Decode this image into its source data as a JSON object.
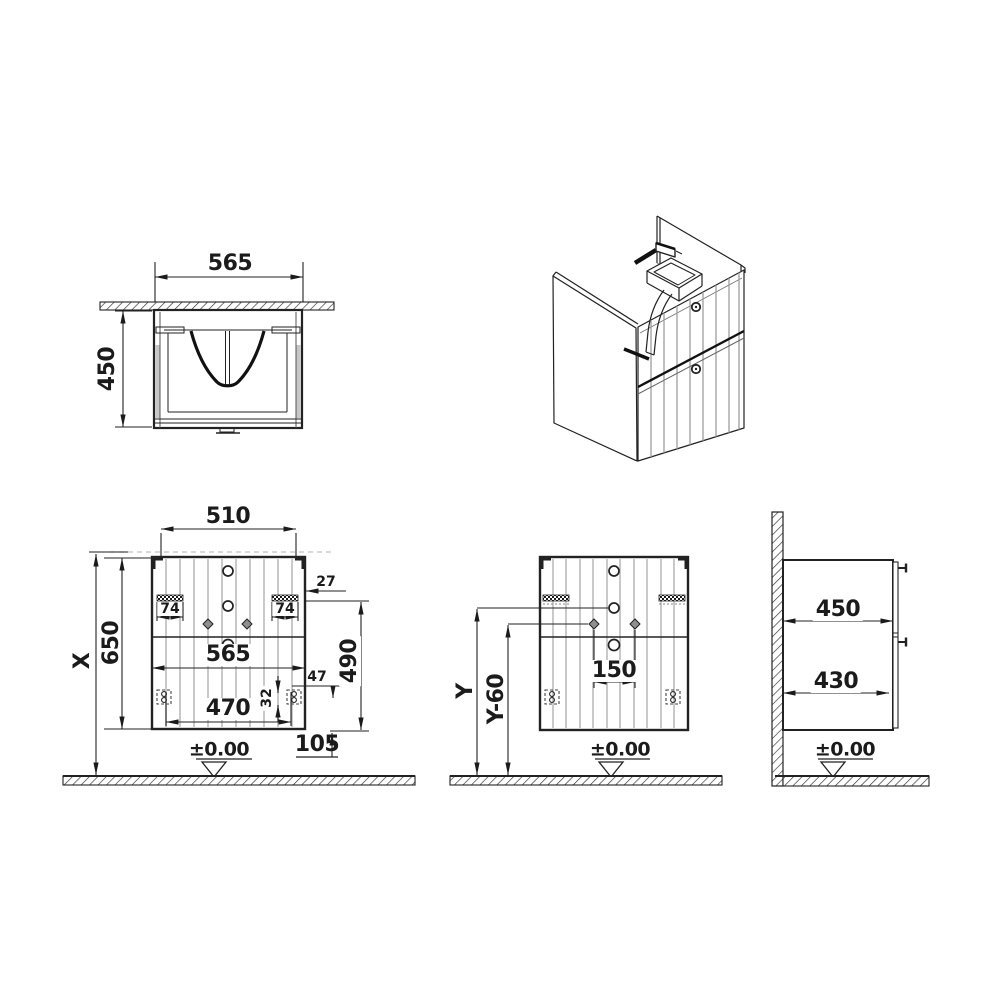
{
  "section_view": {
    "width": "565",
    "height": "450"
  },
  "front_view": {
    "hanger_spacing": "510",
    "overall_height": "X",
    "cabinet_height": "650",
    "cabinet_width": "565",
    "foot_spacing": "470",
    "hanger_left": "74",
    "hanger_right": "74",
    "hanger_edge_offset": "27",
    "drawer_zone_height": "490",
    "foot_inset": "47",
    "foot_height": "32",
    "bottom_clearance": "105",
    "floor_datum": "±0.00"
  },
  "installation_view": {
    "drain_height": "Y",
    "valve_height": "Y-60",
    "valve_spacing": "150",
    "floor_datum": "±0.00"
  },
  "side_view": {
    "carcass_depth": "450",
    "drawer_depth": "430",
    "floor_datum": "±0.00"
  }
}
